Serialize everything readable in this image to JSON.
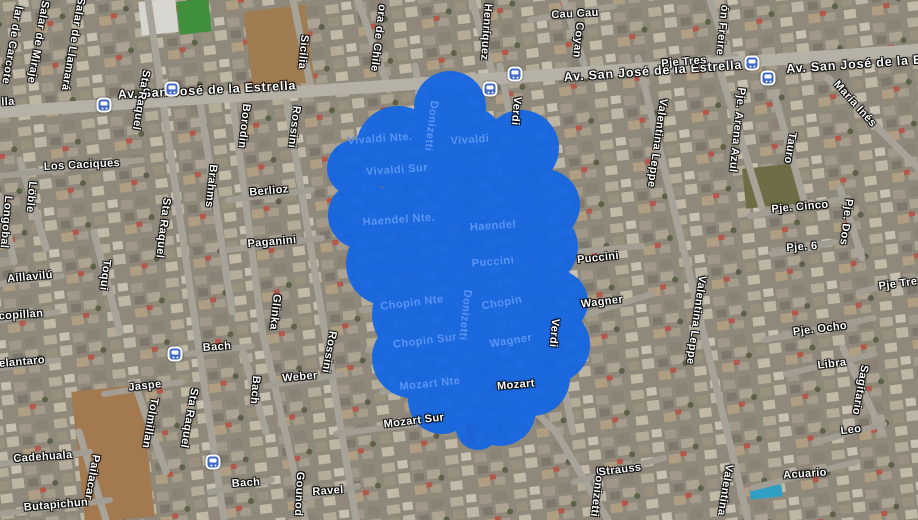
{
  "map": {
    "view": "satellite",
    "selection": {
      "color": "#1466E4",
      "opacity": 0.94,
      "circles": [
        [
          450,
          107,
          36
        ],
        [
          398,
          148,
          42
        ],
        [
          462,
          150,
          46
        ],
        [
          521,
          148,
          38
        ],
        [
          355,
          168,
          28
        ],
        [
          362,
          215,
          34
        ],
        [
          432,
          208,
          52
        ],
        [
          506,
          204,
          48
        ],
        [
          544,
          205,
          36
        ],
        [
          540,
          247,
          38
        ],
        [
          388,
          264,
          42
        ],
        [
          457,
          264,
          52
        ],
        [
          528,
          278,
          42
        ],
        [
          556,
          302,
          32
        ],
        [
          420,
          314,
          48
        ],
        [
          492,
          318,
          48
        ],
        [
          552,
          345,
          38
        ],
        [
          412,
          358,
          40
        ],
        [
          470,
          368,
          48
        ],
        [
          532,
          378,
          38
        ],
        [
          442,
          400,
          34
        ],
        [
          500,
          410,
          36
        ],
        [
          478,
          428,
          22
        ]
      ]
    },
    "transit_icon": {
      "name": "transit-stop-icon",
      "color": "#4169c8"
    },
    "transit_stops": [
      [
        172,
        89
      ],
      [
        104,
        105
      ],
      [
        490,
        89
      ],
      [
        515,
        74
      ],
      [
        752,
        63
      ],
      [
        768,
        78
      ],
      [
        175,
        354
      ],
      [
        213,
        462
      ]
    ],
    "labels": [
      {
        "text": "Av. San José de la Estrella",
        "x": 207,
        "y": 90,
        "r": -3,
        "kind": "avenue"
      },
      {
        "text": "Av. San José de la Estrella",
        "x": 653,
        "y": 71,
        "r": -4,
        "kind": "avenue"
      },
      {
        "text": "Av. San José de la Es",
        "x": 858,
        "y": 64,
        "r": -4,
        "kind": "avenue"
      },
      {
        "text": "lla",
        "x": 8,
        "y": 102,
        "r": -3,
        "kind": "street"
      },
      {
        "text": "Cau Cau",
        "x": 575,
        "y": 14,
        "r": -3,
        "kind": "street"
      },
      {
        "text": "Coyan",
        "x": 578,
        "y": 40,
        "r": 95,
        "kind": "street"
      },
      {
        "text": "Henríquez",
        "x": 486,
        "y": 32,
        "r": 94,
        "kind": "street"
      },
      {
        "text": "ora de Chile",
        "x": 378,
        "y": 38,
        "r": 97,
        "kind": "street"
      },
      {
        "text": "Sicilia",
        "x": 303,
        "y": 52,
        "r": 95,
        "kind": "street"
      },
      {
        "text": "ón Freire",
        "x": 722,
        "y": 30,
        "r": 96,
        "kind": "street"
      },
      {
        "text": "María Inés",
        "x": 855,
        "y": 104,
        "r": 48,
        "kind": "street"
      },
      {
        "text": "lar de Carcote",
        "x": 12,
        "y": 45,
        "r": 100,
        "kind": "street"
      },
      {
        "text": "Salar de Miraje",
        "x": 38,
        "y": 42,
        "r": 100,
        "kind": "street"
      },
      {
        "text": "Salar de Llamará",
        "x": 73,
        "y": 44,
        "r": 100,
        "kind": "street"
      },
      {
        "text": "Sta Raquel",
        "x": 141,
        "y": 100,
        "r": 100,
        "kind": "street"
      },
      {
        "text": "Sta Raquel",
        "x": 163,
        "y": 228,
        "r": 97,
        "kind": "street"
      },
      {
        "text": "Sta Raquel",
        "x": 189,
        "y": 418,
        "r": 100,
        "kind": "street"
      },
      {
        "text": "Los Caciques",
        "x": 82,
        "y": 165,
        "r": -3,
        "kind": "street"
      },
      {
        "text": "Löble",
        "x": 31,
        "y": 197,
        "r": 95,
        "kind": "street"
      },
      {
        "text": "Longobal",
        "x": 6,
        "y": 222,
        "r": 95,
        "kind": "street"
      },
      {
        "text": "Toqui",
        "x": 105,
        "y": 275,
        "r": 97,
        "kind": "street"
      },
      {
        "text": "Aillavilú",
        "x": 30,
        "y": 277,
        "r": -5,
        "kind": "street"
      },
      {
        "text": "copillan",
        "x": 21,
        "y": 315,
        "r": -4,
        "kind": "street"
      },
      {
        "text": "elantaro",
        "x": 22,
        "y": 362,
        "r": -5,
        "kind": "street"
      },
      {
        "text": "Brahms",
        "x": 211,
        "y": 186,
        "r": 96,
        "kind": "street"
      },
      {
        "text": "Borodin",
        "x": 244,
        "y": 126,
        "r": 96,
        "kind": "street"
      },
      {
        "text": "Rossini",
        "x": 294,
        "y": 127,
        "r": 97,
        "kind": "street"
      },
      {
        "text": "Rossini",
        "x": 329,
        "y": 352,
        "r": 100,
        "kind": "street"
      },
      {
        "text": "Berlioz",
        "x": 269,
        "y": 191,
        "r": -5,
        "kind": "street"
      },
      {
        "text": "Paganini",
        "x": 272,
        "y": 242,
        "r": -5,
        "kind": "street"
      },
      {
        "text": "Glinka",
        "x": 275,
        "y": 312,
        "r": 96,
        "kind": "street"
      },
      {
        "text": "Bach",
        "x": 217,
        "y": 347,
        "r": -4,
        "kind": "street"
      },
      {
        "text": "Bach",
        "x": 255,
        "y": 390,
        "r": 95,
        "kind": "street"
      },
      {
        "text": "Weber",
        "x": 300,
        "y": 377,
        "r": -5,
        "kind": "street"
      },
      {
        "text": "Jaspe",
        "x": 145,
        "y": 386,
        "r": -6,
        "kind": "street"
      },
      {
        "text": "Tolmillan",
        "x": 150,
        "y": 423,
        "r": 100,
        "kind": "street"
      },
      {
        "text": "Pailacar",
        "x": 92,
        "y": 477,
        "r": 100,
        "kind": "street"
      },
      {
        "text": "Cadehuala",
        "x": 43,
        "y": 457,
        "r": -4,
        "kind": "street"
      },
      {
        "text": "Butapichun",
        "x": 56,
        "y": 505,
        "r": -5,
        "kind": "street"
      },
      {
        "text": "Bach",
        "x": 246,
        "y": 483,
        "r": -4,
        "kind": "street"
      },
      {
        "text": "Gounod",
        "x": 299,
        "y": 494,
        "r": 93,
        "kind": "street"
      },
      {
        "text": "Ravel",
        "x": 328,
        "y": 491,
        "r": -4,
        "kind": "street"
      },
      {
        "text": "Mozart Sur",
        "x": 414,
        "y": 421,
        "r": -7,
        "kind": "street"
      },
      {
        "text": "Mozart",
        "x": 516,
        "y": 385,
        "r": -5,
        "kind": "street"
      },
      {
        "text": "Donizetti",
        "x": 597,
        "y": 492,
        "r": 97,
        "kind": "street"
      },
      {
        "text": "Strauss",
        "x": 620,
        "y": 470,
        "r": -7,
        "kind": "street"
      },
      {
        "text": "Verdi",
        "x": 516,
        "y": 111,
        "r": 95,
        "kind": "street"
      },
      {
        "text": "Verdi",
        "x": 554,
        "y": 333,
        "r": 95,
        "kind": "street"
      },
      {
        "text": "Puccini",
        "x": 598,
        "y": 258,
        "r": -6,
        "kind": "street"
      },
      {
        "text": "Wagner",
        "x": 602,
        "y": 302,
        "r": -7,
        "kind": "street"
      },
      {
        "text": "Valentina Leppe",
        "x": 657,
        "y": 143,
        "r": 98,
        "kind": "street"
      },
      {
        "text": "Valentina Leppe",
        "x": 696,
        "y": 320,
        "r": 98,
        "kind": "street"
      },
      {
        "text": "Valentina",
        "x": 725,
        "y": 490,
        "r": 99,
        "kind": "street"
      },
      {
        "text": "Pje Tres",
        "x": 684,
        "y": 62,
        "r": -5,
        "kind": "street"
      },
      {
        "text": "Pje. Arena Azul",
        "x": 737,
        "y": 130,
        "r": 96,
        "kind": "street"
      },
      {
        "text": "Tauro",
        "x": 790,
        "y": 148,
        "r": 99,
        "kind": "street"
      },
      {
        "text": "Pje. Cinco",
        "x": 800,
        "y": 207,
        "r": -5,
        "kind": "street"
      },
      {
        "text": "Pje. Dos",
        "x": 846,
        "y": 222,
        "r": 97,
        "kind": "street"
      },
      {
        "text": "Pje. 6",
        "x": 802,
        "y": 247,
        "r": -4,
        "kind": "street"
      },
      {
        "text": "Pje Tre",
        "x": 898,
        "y": 284,
        "r": -8,
        "kind": "street"
      },
      {
        "text": "Pje. Ocho",
        "x": 820,
        "y": 329,
        "r": -7,
        "kind": "street"
      },
      {
        "text": "Libra",
        "x": 832,
        "y": 364,
        "r": -7,
        "kind": "street"
      },
      {
        "text": "Sagitario",
        "x": 860,
        "y": 390,
        "r": 100,
        "kind": "street"
      },
      {
        "text": "Leo",
        "x": 851,
        "y": 430,
        "r": -7,
        "kind": "street"
      },
      {
        "text": "Acuario",
        "x": 805,
        "y": 474,
        "r": -4,
        "kind": "street"
      },
      {
        "text": "Vivaldi Nte.",
        "x": 380,
        "y": 139,
        "r": -4,
        "kind": "blob"
      },
      {
        "text": "Vivaldi",
        "x": 470,
        "y": 140,
        "r": -4,
        "kind": "blob"
      },
      {
        "text": "Vivaldi Sur",
        "x": 397,
        "y": 170,
        "r": -4,
        "kind": "blob"
      },
      {
        "text": "Donizetti",
        "x": 431,
        "y": 126,
        "r": 97,
        "kind": "blob"
      },
      {
        "text": "Haendel Nte.",
        "x": 399,
        "y": 220,
        "r": -4,
        "kind": "blob"
      },
      {
        "text": "Haendel",
        "x": 493,
        "y": 226,
        "r": -4,
        "kind": "blob"
      },
      {
        "text": "Puccini",
        "x": 493,
        "y": 262,
        "r": -5,
        "kind": "blob"
      },
      {
        "text": "Chopin Nte",
        "x": 412,
        "y": 303,
        "r": -7,
        "kind": "blob"
      },
      {
        "text": "Chopin",
        "x": 502,
        "y": 303,
        "r": -10,
        "kind": "blob"
      },
      {
        "text": "Chopin Sur",
        "x": 425,
        "y": 341,
        "r": -7,
        "kind": "blob"
      },
      {
        "text": "Donizetti",
        "x": 465,
        "y": 315,
        "r": 96,
        "kind": "blob"
      },
      {
        "text": "Wagner",
        "x": 511,
        "y": 341,
        "r": -9,
        "kind": "blob"
      },
      {
        "text": "Mozart Nte",
        "x": 430,
        "y": 384,
        "r": -6,
        "kind": "blob"
      }
    ]
  }
}
